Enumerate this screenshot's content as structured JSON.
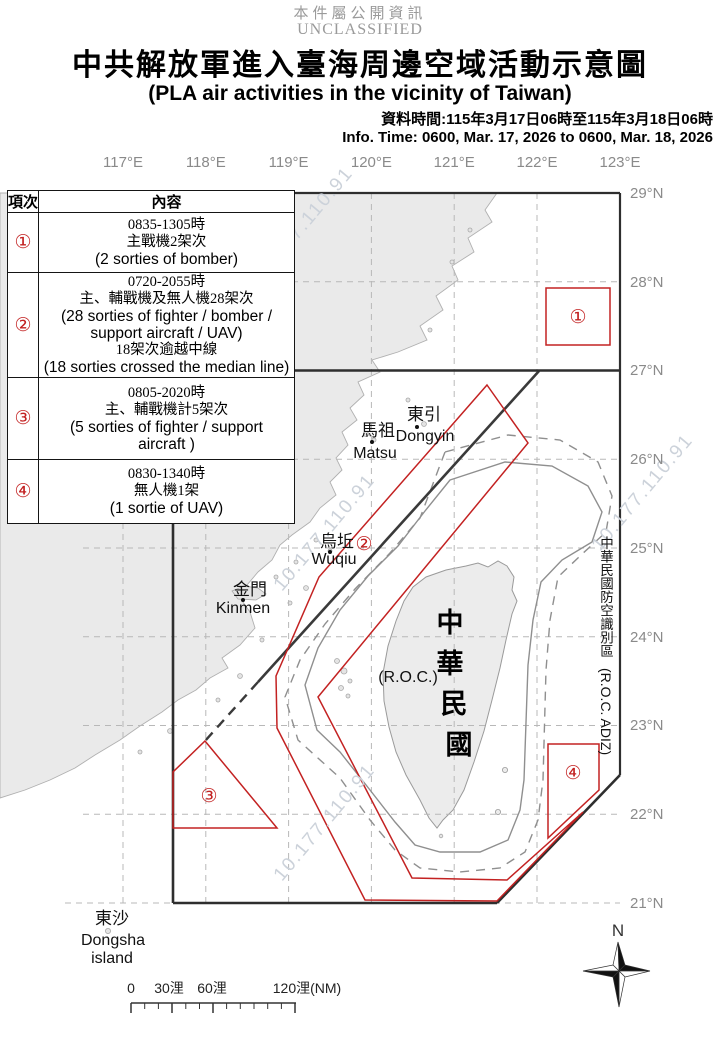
{
  "classification": {
    "zh": "本件屬公開資訊",
    "en": "UNCLASSIFIED"
  },
  "title": {
    "zh": "中共解放軍進入臺海周邊空域活動示意圖",
    "en": "(PLA air activities in the vicinity of Taiwan)"
  },
  "info_time": {
    "zh": "資料時間:115年3月17日06時至115年3月18日06時",
    "en": "Info. Time: 0600, Mar. 17, 2026 to 0600, Mar. 18, 2026"
  },
  "table": {
    "headers": [
      "項次",
      "內容"
    ],
    "rows": [
      {
        "id": "①",
        "lines": [
          "0835-1305時",
          "主戰機2架次",
          "(2 sorties of bomber)"
        ]
      },
      {
        "id": "②",
        "lines": [
          "0720-2055時",
          "主、輔戰機及無人機28架次",
          "(28 sorties of fighter / bomber /",
          "support aircraft / UAV)",
          "18架次逾越中線",
          "(18 sorties crossed the median line)"
        ]
      },
      {
        "id": "③",
        "lines": [
          "0805-2020時",
          "主、輔戰機計5架次",
          "(5 sorties of fighter / support",
          "aircraft )"
        ]
      },
      {
        "id": "④",
        "lines": [
          "0830-1340時",
          "無人機1架",
          "(1 sortie of UAV)"
        ]
      }
    ]
  },
  "map": {
    "longitude_labels": [
      "117°E",
      "118°E",
      "119°E",
      "120°E",
      "121°E",
      "122°E",
      "123°E"
    ],
    "latitude_labels": [
      "29°N",
      "28°N",
      "27°N",
      "26°N",
      "25°N",
      "24°N",
      "23°N",
      "22°N",
      "21°N"
    ],
    "region_markers": [
      "①",
      "②",
      "③",
      "④"
    ],
    "places": {
      "dongyin": {
        "zh": "東引",
        "en": "Dongyin"
      },
      "matsu": {
        "zh": "馬祖",
        "en": "Matsu"
      },
      "wuqiu": {
        "zh": "烏坵",
        "en": "Wuqiu"
      },
      "kinmen": {
        "zh": "金門",
        "en": "Kinmen"
      },
      "dongsha": {
        "zh": "東沙",
        "en_line1": "Dongsha",
        "en_line2": "island"
      },
      "taiwan": {
        "chars": [
          "中",
          "華",
          "民",
          "國"
        ],
        "en": "(R.O.C.)"
      }
    },
    "adiz_label": {
      "chars": [
        "中",
        "華",
        "民",
        "國",
        "防",
        "空",
        "識",
        "別",
        "區"
      ],
      "en": "(R.O.C. ADIZ)"
    },
    "watermark": "10.177.110.91",
    "scale_bar": {
      "labels": [
        "0",
        "30浬",
        "60浬",
        "120浬(NM)"
      ]
    },
    "compass_north": "N",
    "colors": {
      "activity_red": "#c32222",
      "boundary_dark": "#3a3a3a",
      "land_gray": "#eaeaea"
    }
  }
}
